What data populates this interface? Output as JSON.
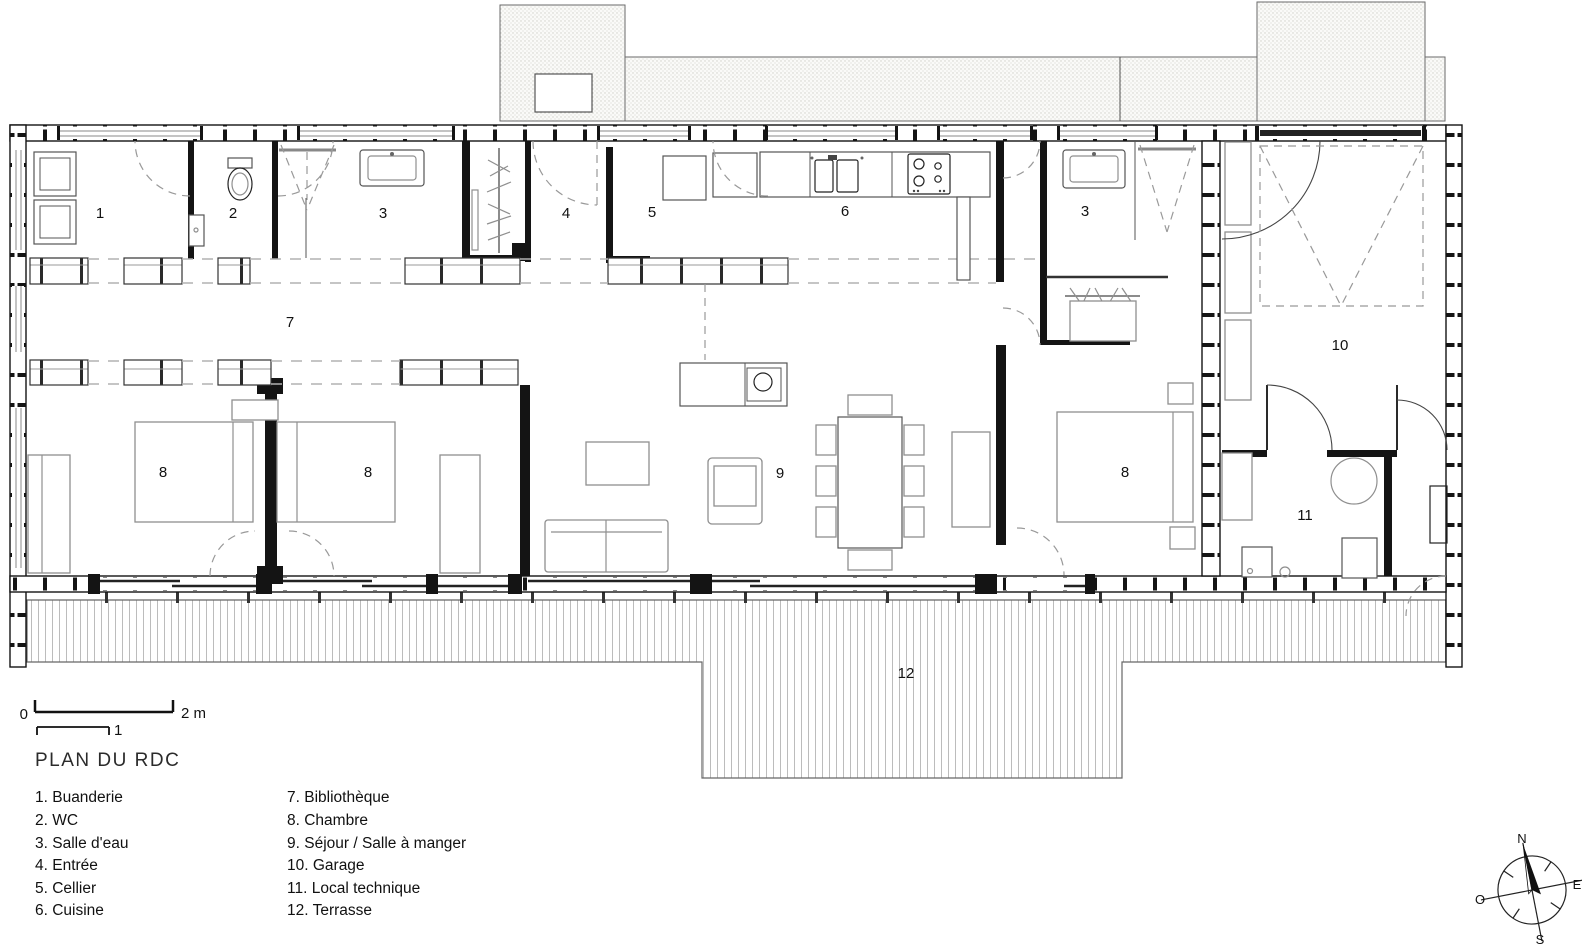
{
  "title": "PLAN DU RDC",
  "scale_bar": {
    "zero": "0",
    "one": "1",
    "two": "2 m"
  },
  "compass": {
    "north": "N",
    "east": "E",
    "south": "S",
    "west": "O"
  },
  "legend": {
    "column1": [
      "1. Buanderie",
      "2. WC",
      "3. Salle d'eau",
      "4. Entrée",
      "5. Cellier",
      "6. Cuisine"
    ],
    "column2": [
      "7. Bibliothèque",
      "8. Chambre",
      "9. Séjour / Salle à manger",
      "10. Garage",
      "11. Local technique",
      "12. Terrasse"
    ]
  },
  "plan": {
    "labels": {
      "buanderie": "1",
      "wc": "2",
      "salle_eau_1": "3",
      "entree": "4",
      "cellier": "5",
      "cuisine": "6",
      "bibliotheque": "7",
      "chambre_1": "8",
      "chambre_2": "8",
      "sejour": "9",
      "chambre_3": "8",
      "salle_eau_2": "3",
      "garage": "10",
      "local_technique": "11",
      "terrasse": "12"
    }
  },
  "colors": {
    "wall": "#141414",
    "furniture": "#8f8f8f",
    "paving_dots": "#cfcfca",
    "deck_line": "#b5b5b5"
  }
}
